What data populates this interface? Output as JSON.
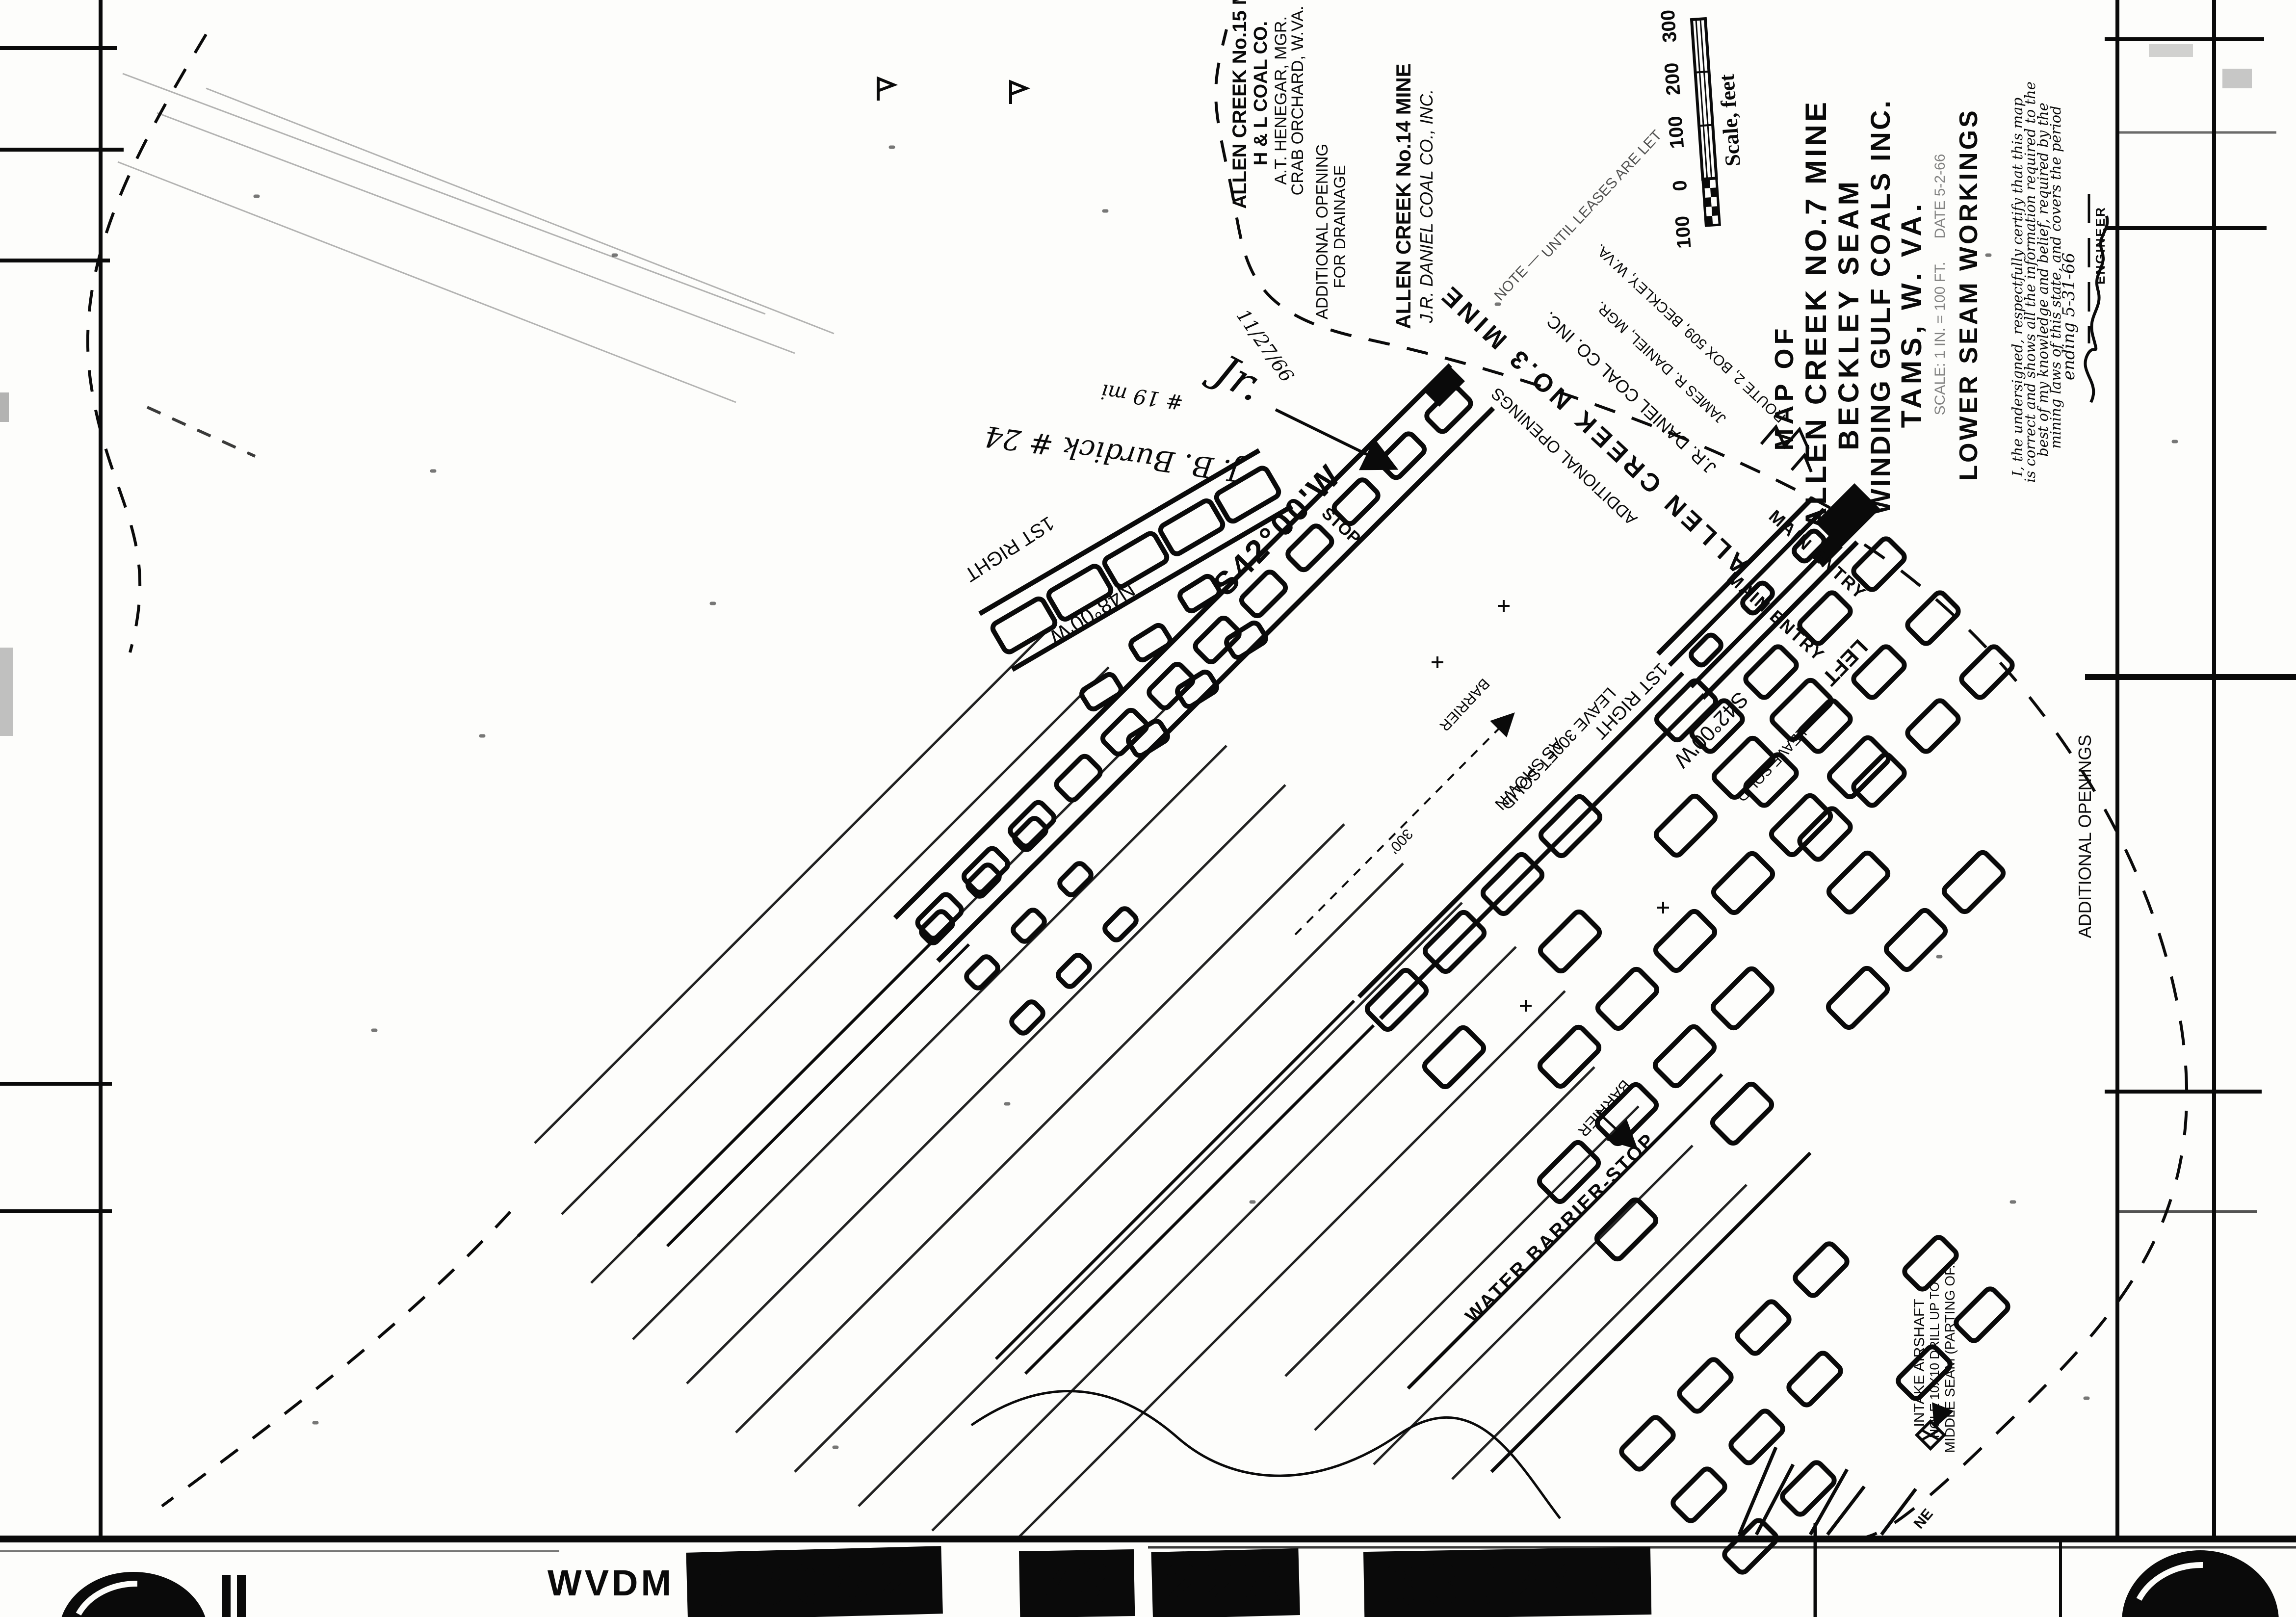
{
  "film_strip": {
    "agency_code": "WVDM",
    "code1": "03082",
    "code2": "73",
    "code3": "22X",
    "code4": "330249"
  },
  "title_block": {
    "l1": "MAP OF",
    "l2": "ALLEN CREEK NO.7 MINE",
    "l3": "BECKLEY SEAM",
    "l4": "WINDING GULF COALS INC.",
    "l5": "TAMS, W. VA.",
    "l6": "LOWER SEAM WORKINGS",
    "scale_note": "SCALE: 1 IN. = 100 FT.",
    "date_note": "DATE 5-2-66"
  },
  "scale_bar": {
    "caption": "Scale, feet",
    "t0": "300",
    "t1": "200",
    "t2": "100",
    "t3": "0",
    "t4": "100"
  },
  "mine15": {
    "l1": "ALLEN CREEK No.15 MINE",
    "l2": "H & L COAL CO.",
    "l3": "A.T. HENEGAR, MGR.",
    "l4": "CRAB ORCHARD, W.VA."
  },
  "mine14": {
    "l1": "ALLEN CREEK No.14 MINE",
    "l2": "J.R. DANIEL COAL CO., INC."
  },
  "mine3": {
    "l1": "ALLEN CREEK NO.3 MINE",
    "l2": "J.R. DANIEL COAL CO. INC.",
    "l3": "JAMES R. DANIEL, MGR.",
    "l4": "ROUTE 2, BOX 509, BECKLEY, W.VA.",
    "note1": "NOTE —",
    "note2": "UNTIL LEASES ARE LET"
  },
  "labels": {
    "main_entry": "MAIN ENTRY",
    "bearing_main": "S42°00'W",
    "bearing_right": "N48°00'W",
    "first_right": "1ST RIGHT",
    "left": "LEFT",
    "stop": "STOP",
    "leave_solid_1": "LEAVE 300FT SOLID",
    "leave_solid_2": "AS SHOWN",
    "leave_solid_3": "LEAVE SOLID",
    "barrier_300": "300'",
    "barrier": "BARRIER",
    "water_barrier_stop": "WATER  BARRIER-STOP",
    "drainage_1": "ADDITIONAL OPENING",
    "drainage_2": "FOR DRAINAGE",
    "additional_openings": "ADDITIONAL OPENINGS",
    "intake_1": "INTAKE  AIRSHAFT",
    "intake_2": "HOLE 10X10 DRILL UP TO",
    "intake_3": "MIDDLE SEAM (PARTING OF...",
    "ne_fragment": "NE"
  },
  "certification": {
    "l1": "I, the undersigned, respectfully certify that this map",
    "l2": "is correct and shows all the information required to the",
    "l3": "best of my knowledge and belief, required by the",
    "l4": "mining laws of this state, and covers the period",
    "l5": "ending 5-31-66",
    "signed_title": "ENGINEER"
  },
  "handwriting": {
    "name": "J. B. Burdick # 24",
    "count": "# 19 mi",
    "initials": "Jr.",
    "date": "11/27/66"
  },
  "ink_color": "#0a0a0a",
  "paper_color": "#fdfdfb"
}
